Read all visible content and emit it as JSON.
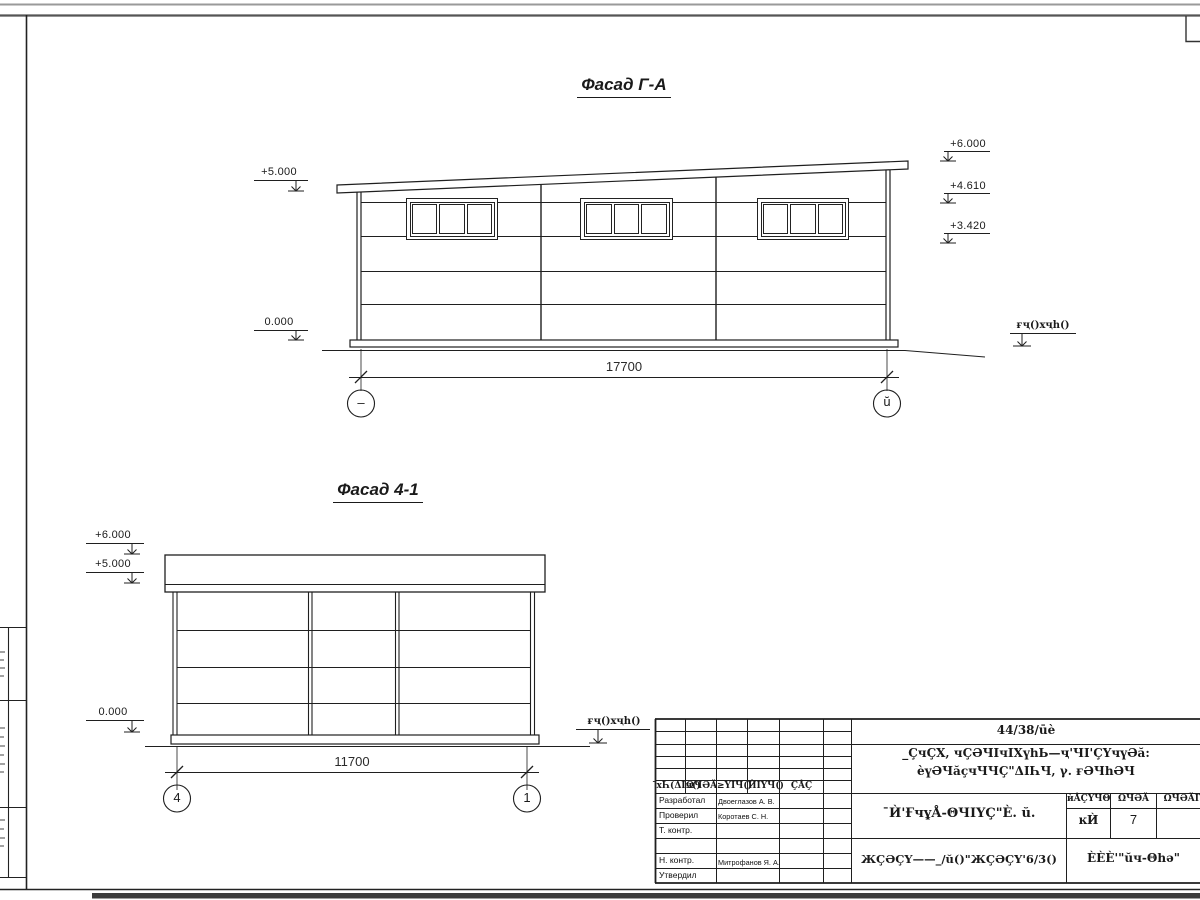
{
  "facade_ga": {
    "title": "Фасад Г-А",
    "elev_left_top": "+5.000",
    "elev_left_bottom": "0.000",
    "elev_right_top": "+6.000",
    "elev_right_mid": "+4.610",
    "elev_right_low": "+3.420",
    "ground_label": "ғҷ()хҷһ()",
    "dimension": "17700",
    "axis_left": "–",
    "axis_right": "ŭ"
  },
  "facade_41": {
    "title": "Фасад 4-1",
    "elev_top": "+6.000",
    "elev_mid": "+5.000",
    "elev_zero": "0.000",
    "ground_label": "ғҷ()хҷһ()",
    "dimension": "11700",
    "axis_left": "4",
    "axis_right": "1"
  },
  "title_block": {
    "doc_number": "44/38/ūè",
    "project_line1": "_ÇчÇХ, чÇӘЧIчIХүһЬ—ҷ'ЧI'ÇҮчүӘă:",
    "project_line2": "ѐүӘЧăçчЧЧÇ\"ΔIҺЧ, γ. ғӘЧһӘЧ",
    "sheet_name": "¯Ѝ'ҒчұÅ-ΘЧIҮÇ\"È. ŭ.",
    "doc_code": "ЖÇӘÇҮ——_/ŭ()\"ЖÇӘÇҮ'6/3()",
    "company": "ÈÈÈ'\"ŭч-Θһә\"",
    "stage_label": "ѝÅÇҮЧΘ",
    "sheet_col_label": "ΩЧӘĂ",
    "sheets_total_label": "ΩЧӘĂIҮ",
    "stage_value": "ĸЍ",
    "sheet_number": "7",
    "header_cells": [
      "¯хҺ(ΔIч()",
      "ΩЧӘĂ",
      "≥ҮIЧ()",
      "ЍIҮЧ()",
      "ÇÅÇ"
    ],
    "rows": [
      {
        "role": "Разработал",
        "name": "Двоеглазов А. В."
      },
      {
        "role": "Проверил",
        "name": "Коротаев С. Н."
      },
      {
        "role": "Т. контр.",
        "name": ""
      },
      {
        "role": "Н. контр.",
        "name": "Митрофанов Я. А."
      },
      {
        "role": "Утвердил",
        "name": ""
      }
    ]
  }
}
